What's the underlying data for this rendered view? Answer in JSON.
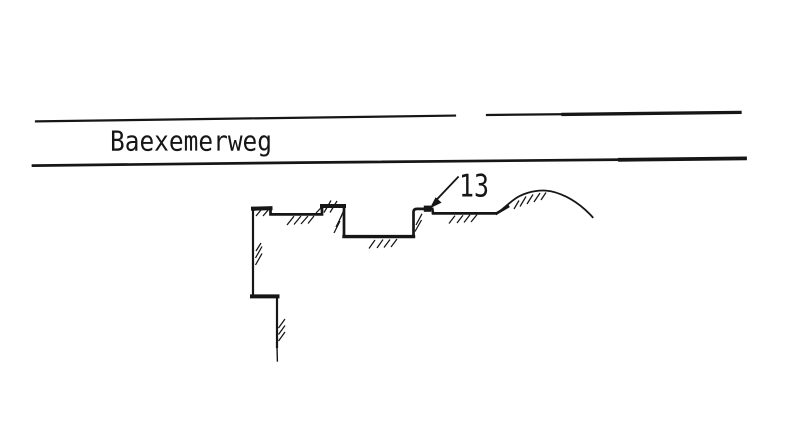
{
  "road": {
    "name": "Baexemerweg"
  },
  "parcel": {
    "number": "13"
  },
  "colors": {
    "ink": "#161616",
    "paper": "#ffffff"
  }
}
